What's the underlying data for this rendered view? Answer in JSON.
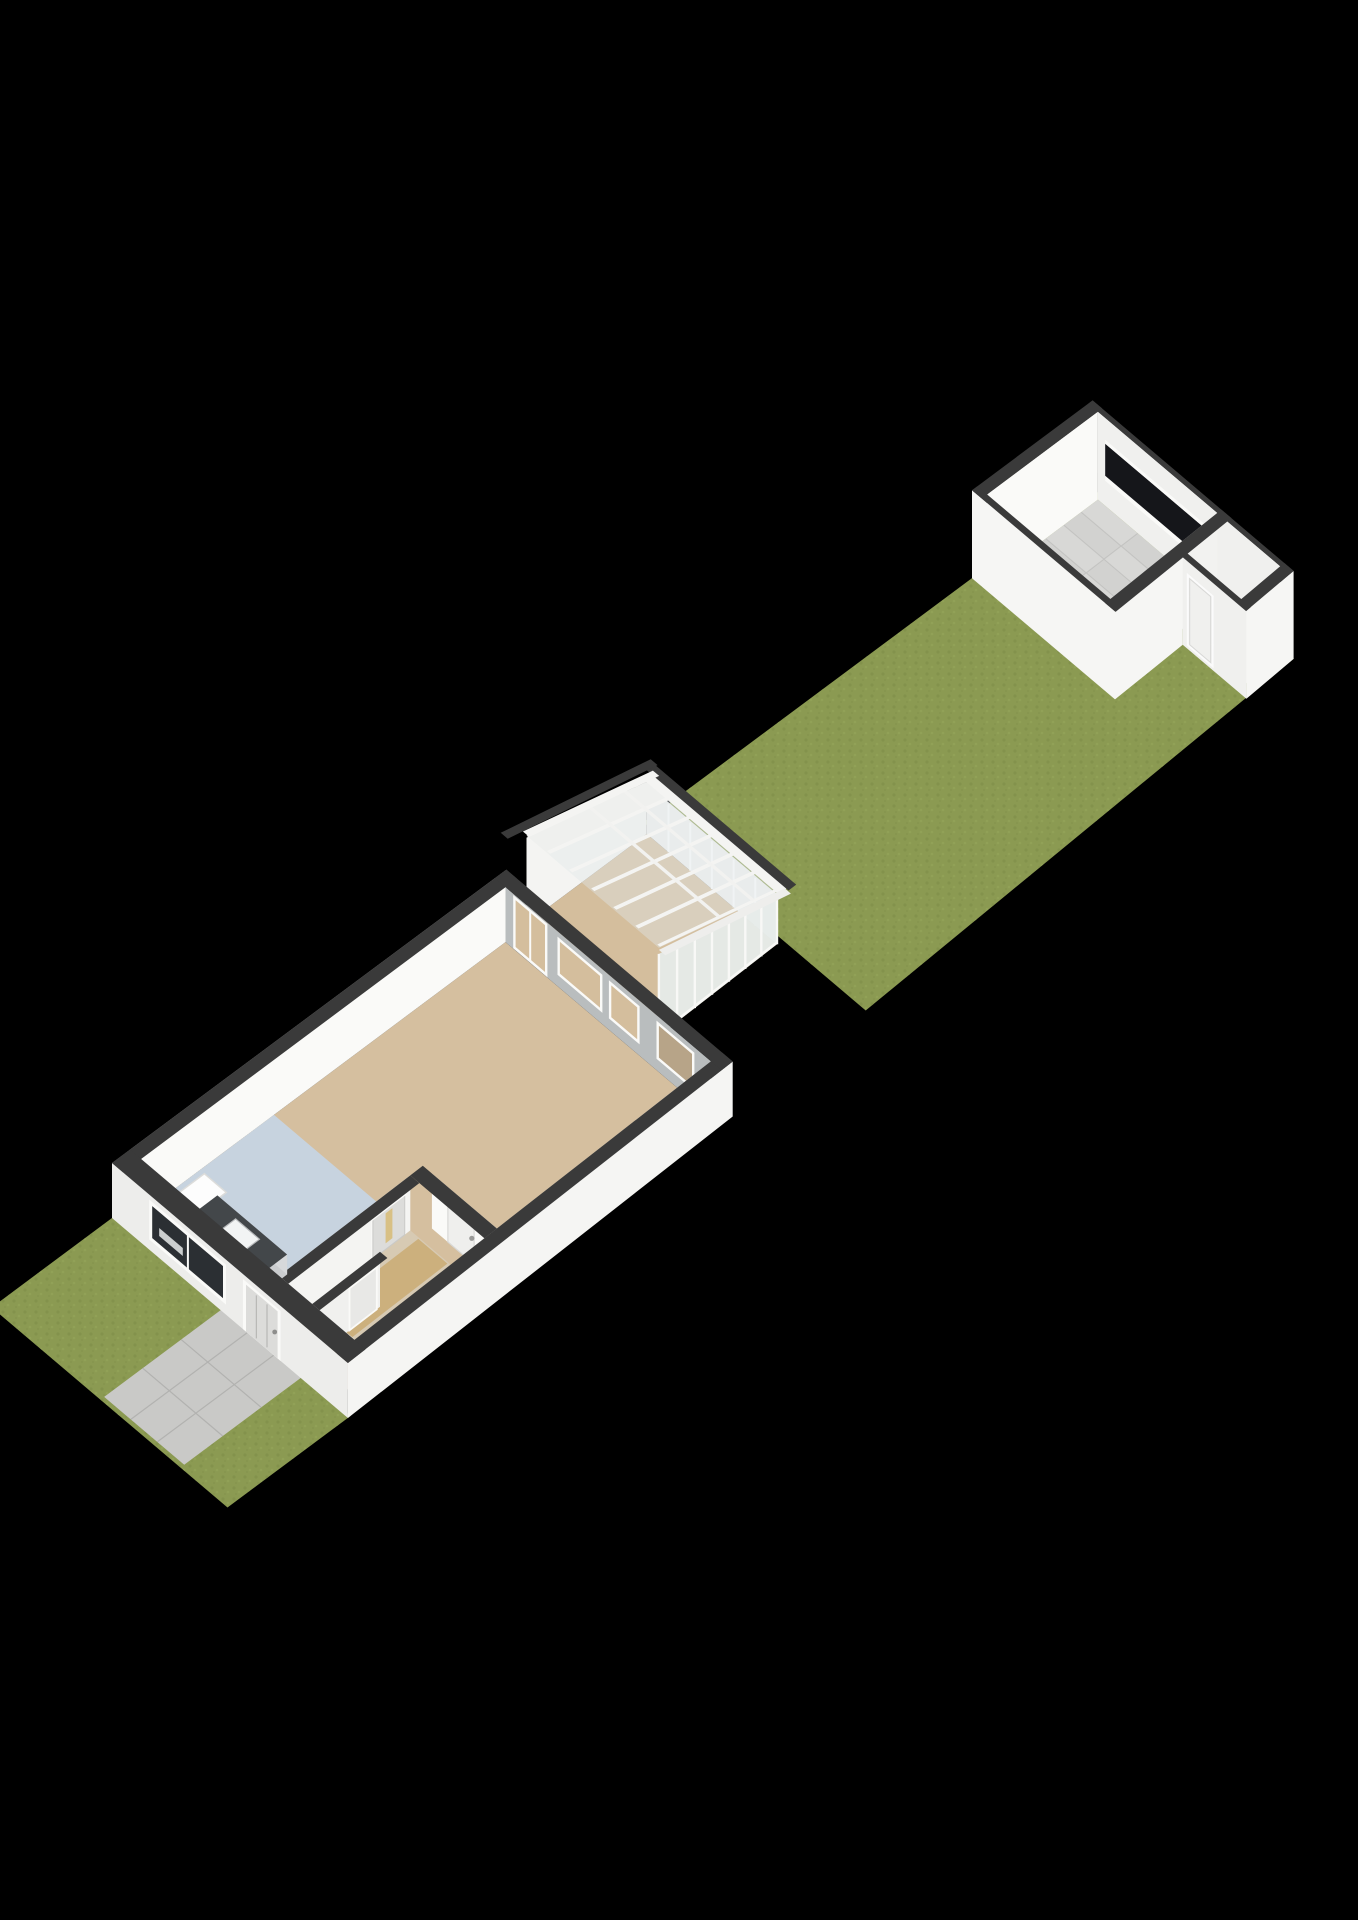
{
  "scene": {
    "type": "3d-floorplan-render",
    "view": "isometric-dollhouse",
    "background": "#000000",
    "canvas": {
      "width": 1358,
      "height": 1920
    }
  },
  "colors": {
    "wall_cap": "#3a3a3a",
    "wall_exterior_light": "#f0f0ee",
    "wall_exterior_bright": "#f6f6f4",
    "wall_exterior_shade": "#c9c9c7",
    "wall_interior": "#fafaf8",
    "wall_interior_soft": "#f2f2f0",
    "wall_back_shade": "#b9bdbe",
    "floor_living": "#d5bf9f",
    "floor_kitchen": "#c7d3df",
    "floor_hall": "#d7cab3",
    "floor_wood": "#c9a96f",
    "floor_conservatory": "#d4be9d",
    "floor_tiles": "#d8d8d6",
    "tile_line": "#c6c6c4",
    "floor_storage": "#cdb791",
    "grass": "#8b9a52",
    "grass_dark": "#7c8c47",
    "grass_light": "#98a75c",
    "path": "#c9c9c7",
    "path_line": "#b2b2b0",
    "glass_roof": "rgba(223,230,233,0.42)",
    "glass_frosted": "#eff0ee",
    "glass_side": "#e6ebe9",
    "frame_white": "#f4f4f2",
    "window_dark": "#2b2f33",
    "opening_dark": "#15161a",
    "transom": "#dfc88e",
    "door_slit": "#d8c084",
    "counter": "#43474a",
    "counter_side": "#caccce",
    "sink": "#f2f4f4",
    "door_leaf": "#dcdcda",
    "door_frame": "#fafaf8",
    "fixture": "#fdfdfd"
  },
  "structures": {
    "house": {
      "label": "main house",
      "rooms": [
        "living room",
        "kitchen",
        "hallway",
        "toilet"
      ],
      "features": [
        "front door",
        "front window",
        "kitchen counter with sink",
        "shower tray",
        "hall door with transom",
        "living room door",
        "rear door and windows to conservatory"
      ]
    },
    "conservatory": {
      "label": "conservatory",
      "features": [
        "glass pitched roof",
        "glass side wall",
        "roof rails",
        "frosted end panel"
      ]
    },
    "garden": {
      "label": "back garden"
    },
    "front_yard": {
      "label": "front yard",
      "features": [
        "tiled path"
      ]
    },
    "outbuilding": {
      "label": "outbuilding",
      "rooms": [
        "main room with tiled floor",
        "storage room"
      ],
      "features": [
        "rear opening band",
        "side door outline"
      ]
    }
  },
  "geometry": {
    "plot_width": 6.4,
    "front_yard_x0": -2.5,
    "house": {
      "x0": 0,
      "x1": 8.2
    },
    "conservatory": {
      "x0": 8.2,
      "x1": 12.2,
      "y1": 4.2
    },
    "garden": {
      "x0": 12.18,
      "x1": 33.62
    },
    "outbuilding": {
      "x0": 26,
      "x1": 33.6,
      "partition_y": 4.4,
      "small_room_x0": 30.2
    },
    "wall_thickness": 0.3,
    "wall_height_px": {
      "house": 55,
      "outbuilding": 88,
      "conservatory_low": 52,
      "conservatory_high": 88
    },
    "projection": {
      "origin": [
        112,
        1218
      ],
      "u": [
        0.8023,
        -0.5969
      ],
      "f_scale": 2350,
      "f_depth": 31,
      "v": [
        0.763,
        0.647
      ],
      "v_scale": 48.3,
      "v_falloff": 0.16,
      "neg_scale": 60
    }
  }
}
